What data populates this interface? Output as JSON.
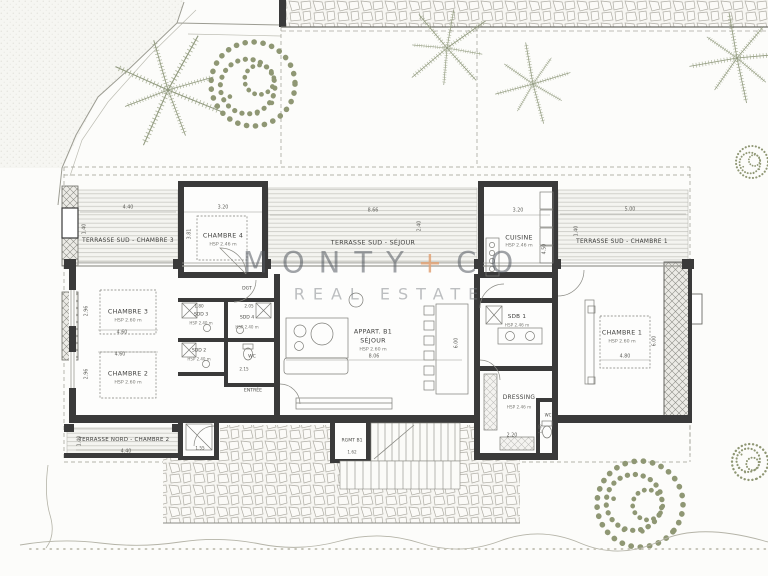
{
  "palette": {
    "wall": "#3a3a3a",
    "foliage": "#8f9774",
    "stone_line": "#b0aea6",
    "watermark_text": "#555a62",
    "watermark_plus": "#e0a276"
  },
  "garden": {
    "label": "JARDIN B1"
  },
  "watermark": {
    "name": "MONTY",
    "plus": "+",
    "co": "CO",
    "subtitle": "REAL ESTATE"
  },
  "rooms": {
    "terrasse_sud_ch3": {
      "name": "TERRASSE SUD - CHAMBRE 3"
    },
    "chambre4": {
      "name": "CHAMBRE 4",
      "hsp": "HSP 2.46 m"
    },
    "terrasse_sud_sejour": {
      "name": "TERRASSE SUD - SÉJOUR"
    },
    "cuisine": {
      "name": "CUISINE",
      "hsp": "HSP 2.46 m"
    },
    "terrasse_sud_ch1": {
      "name": "TERRASSE SUD - CHAMBRE 1"
    },
    "chambre3": {
      "name": "CHAMBRE 3",
      "hsp": "HSP 2.60 m"
    },
    "chambre2": {
      "name": "CHAMBRE 2",
      "hsp": "HSP 2.60 m"
    },
    "chambre1": {
      "name": "CHAMBRE 1",
      "hsp": "HSP 2.60 m"
    },
    "dgt": {
      "name": "DGT"
    },
    "sdd3": {
      "name": "SDD 3",
      "hsp": "HSP 2.40 m"
    },
    "sdd4": {
      "name": "SDD 4",
      "hsp": "HSP 2.40 m"
    },
    "sdd2": {
      "name": "SDD 2",
      "hsp": "HSP 2.40 m"
    },
    "wc": {
      "name": "WC"
    },
    "entree": {
      "name": "ENTRÉE"
    },
    "sejour": {
      "name": "APPART. B1",
      "name2": "SÉJOUR",
      "hsp": "HSP 2.60 m"
    },
    "sdb1": {
      "name": "SDB 1",
      "hsp": "HSP 2.46 m"
    },
    "dressing": {
      "name": "DRESSING",
      "hsp": "HSP 2.46 m"
    },
    "wc2": {
      "name": "WC"
    },
    "rgmt": {
      "name": "RGMT B1"
    },
    "terrasse_nord_ch2": {
      "name": "TERRASSE NORD - CHAMBRE 2"
    }
  },
  "dims": {
    "t3_w": "4.40",
    "c4_w": "3.20",
    "tsj_w": "8.66",
    "cui_w": "3.20",
    "t1_w": "5.00",
    "t3_d": "1.40",
    "c4_d": "3.81",
    "tsj_d": "2.40",
    "cui_d": "4.50",
    "t1_d": "1.40",
    "c3_w": "4.60",
    "c3_d": "2.96",
    "c2_w": "4.60",
    "c2_d": "2.96",
    "sej_w": "8.06",
    "sej_d": "6.00",
    "c1_w": "4.80",
    "c1_d": "6.00",
    "sdd3_w": "1.80",
    "sdd4_w": "2.05",
    "wc_w": "2.15",
    "dress_w": "2.20",
    "wc2_d": "1.40",
    "ext_w": "1.55",
    "rgmt_w": "1.62",
    "tn_w": "4.40",
    "tn_d": "1.40"
  }
}
